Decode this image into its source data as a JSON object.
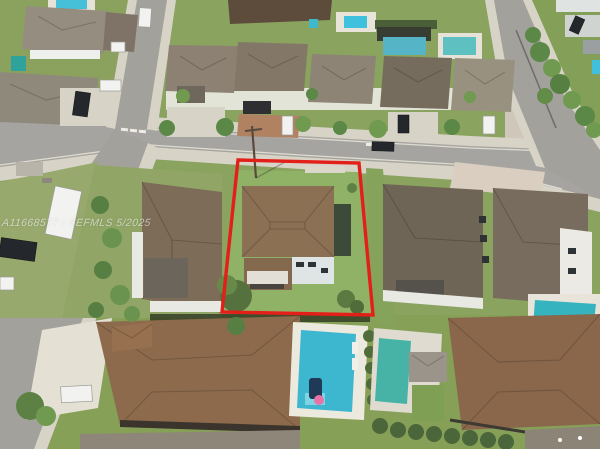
{
  "meta": {
    "type": "aerial-drone-photograph",
    "description": "Overhead drone photo of a suburban Miami-style residential neighborhood; a red quadrilateral outlines the listed property lot in the center, containing a two-story house with brown hip tile roof, a detached casita and a large grassy back yard.",
    "width": 600,
    "height": 449
  },
  "watermark": {
    "text": "A11668577 / SEFMLS 5/2025"
  },
  "annotations": {
    "property_outline": {
      "color": "#e31f1a",
      "points": "238,160 359,163 373,315 222,312",
      "meaning": "boundary of the highlighted listing lot"
    }
  },
  "palette": {
    "asphalt": "#a6a4a0",
    "sidewalk_concrete": "#d8d3c7",
    "grass": "#8aa35f",
    "subject_lawn": "#8fb266",
    "roof_brown": "#8b7054",
    "roof_gray_brown": "#8c8172",
    "roof_terracotta": "#8d6a4c",
    "pool_blue": "#3db6cf",
    "pool_teal": "#46b3a6",
    "hedge_green": "#4c663b",
    "outline_red": "#e31f1a"
  },
  "scene": {
    "subject_property": "two-story home with brown hip roof, detached casita with white awning, fenced green lawn, outlined in red",
    "left_neighbor": "large brown hip-roof house with palm hedge along street",
    "right_neighbors": "two gray-brown roof two-story houses with paver driveway and rear pool",
    "top_row": "five houses fronting the street with backyard pools and pergola",
    "bottom_row": "terracotta-roof houses with two backyard swimming pools, loungers and hedges",
    "streets_visible": 3,
    "pools_visible": 8,
    "parked_cars_visible": 10,
    "crosswalk_markings": "white dashes near both intersections",
    "utility_pole": "wooden pole with crossarm at the front-left corner of the subject lot"
  }
}
